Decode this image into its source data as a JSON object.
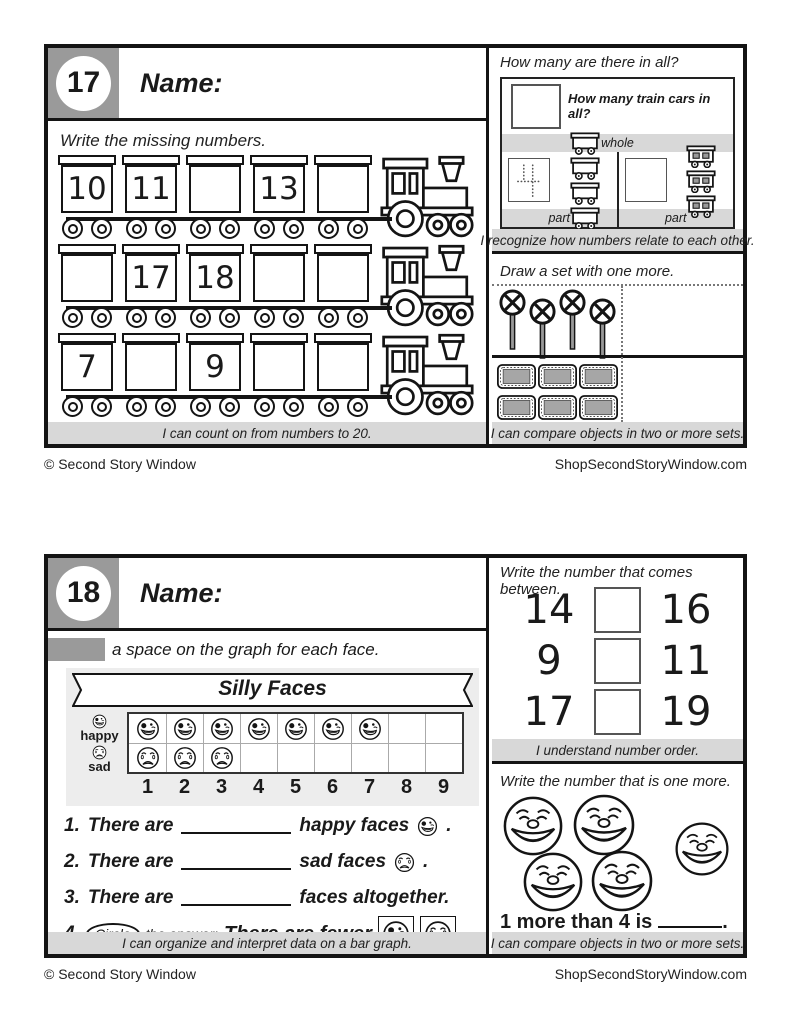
{
  "page": {
    "copyright": "© Second Story Window",
    "site": "ShopSecondStoryWindow.com"
  },
  "card17": {
    "badge": "17",
    "name_label": "Name:",
    "left": {
      "prompt": "Write the missing numbers.",
      "trains": [
        {
          "cars": [
            "10",
            "11",
            "",
            "13",
            ""
          ]
        },
        {
          "cars": [
            "",
            "17",
            "18",
            "",
            ""
          ]
        },
        {
          "cars": [
            "7",
            "",
            "9",
            "",
            ""
          ]
        }
      ],
      "footer": "I can count on from numbers to 20."
    },
    "right_top": {
      "prompt": "How many are there in all?",
      "question": "How many train cars in all?",
      "whole_label": "whole",
      "part_label_left": "part",
      "part_label_right": "part",
      "trace_numeral": "4",
      "left_part_car_count": 4,
      "right_part_car_count": 3,
      "footer": "I recognize how numbers relate to each other."
    },
    "right_bottom": {
      "prompt": "Draw a set with one more.",
      "sign_count": 4,
      "ticket_count": 6,
      "footer": "I can compare objects in two or more sets."
    }
  },
  "card18": {
    "badge": "18",
    "name_label": "Name:",
    "left": {
      "prompt": "a space on the graph for each face.",
      "graph": {
        "title": "Silly Faces",
        "rows": [
          {
            "label": "happy",
            "count": 7
          },
          {
            "label": "sad",
            "count": 3
          }
        ],
        "columns": 9,
        "axis": [
          "1",
          "2",
          "3",
          "4",
          "5",
          "6",
          "7",
          "8",
          "9"
        ]
      },
      "questions": {
        "q1": {
          "num": "1.",
          "pre": "There are",
          "post": "happy faces",
          "end": "."
        },
        "q2": {
          "num": "2.",
          "pre": "There are",
          "post": "sad faces",
          "end": "."
        },
        "q3": {
          "num": "3.",
          "pre": "There are",
          "post": "faces altogether."
        },
        "q4": {
          "num": "4.",
          "circle": "Circle",
          "mid": "the answer:",
          "statement": "There are fewer"
        }
      },
      "footer": "I can organize and interpret data on a bar graph."
    },
    "right_top": {
      "prompt": "Write the number that comes between.",
      "rows": [
        {
          "left": "14",
          "right": "16"
        },
        {
          "left": "9",
          "right": "11"
        },
        {
          "left": "17",
          "right": "19"
        }
      ],
      "footer": "I understand number order."
    },
    "right_bottom": {
      "prompt": "Write the number that is one more.",
      "face_count": 5,
      "statement": "1 more than 4 is",
      "end": ".",
      "footer": "I can compare objects in two or more sets."
    }
  },
  "chart_data": {
    "type": "bar",
    "title": "Silly Faces",
    "categories": [
      "happy",
      "sad"
    ],
    "values": [
      7,
      3
    ],
    "xlabel": "",
    "ylabel": "",
    "x_ticks": [
      "1",
      "2",
      "3",
      "4",
      "5",
      "6",
      "7",
      "8",
      "9"
    ],
    "xlim": [
      0,
      9
    ],
    "orientation": "horizontal",
    "grid": true,
    "legend": "none"
  }
}
